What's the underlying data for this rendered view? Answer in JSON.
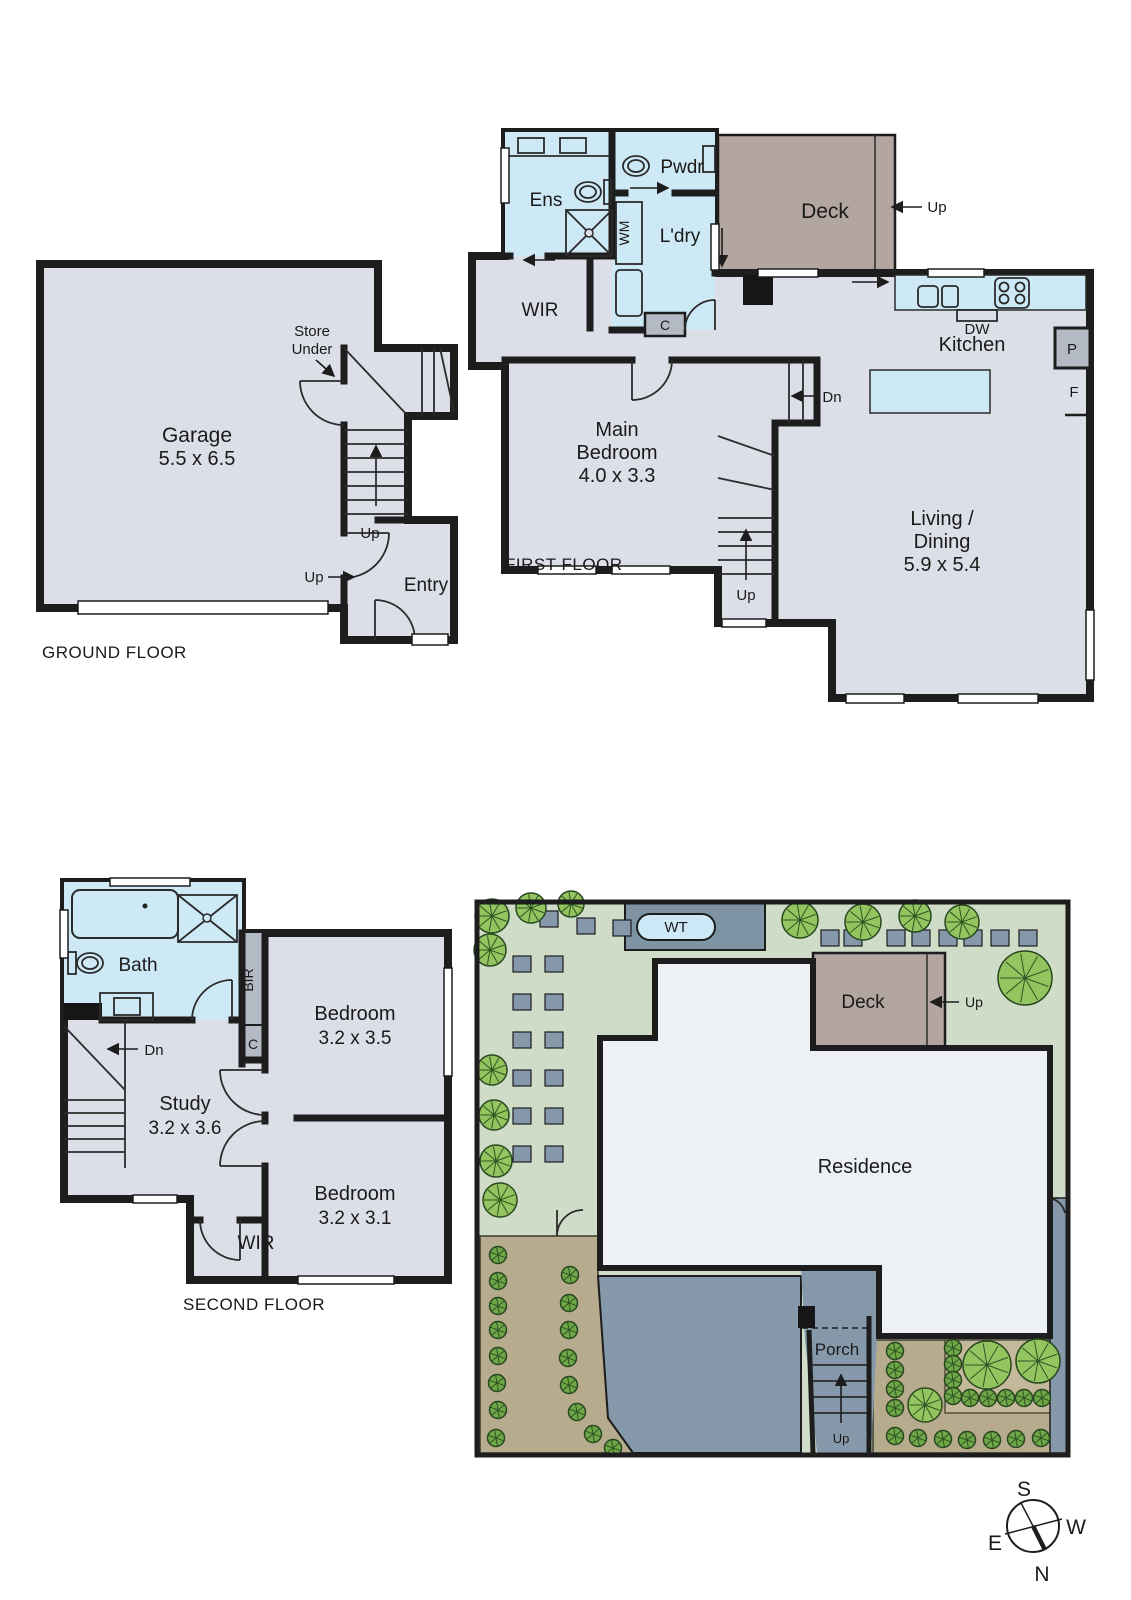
{
  "colors": {
    "wall": "#1d1d1d",
    "room_fill": "#dcdfe7",
    "wet_area_fill": "#cde9f6",
    "deck_fill": "#b3a59f",
    "cupboard_fill": "#b3bac3",
    "residence_fill": "#edf0f5",
    "grass_fill": "#cfdcc8",
    "path_fill": "#b7ab8e",
    "garden_bed_fill": "#c4b99b",
    "driveway_fill": "#8699aa",
    "water_tank_strip_fill": "#7e93a4",
    "water_tank_pill_fill": "#cde9f7",
    "tree_fill": "#94c45f",
    "bush_fill": "#6fa647"
  },
  "ground_floor": {
    "title": "GROUND FLOOR",
    "garage_label": "Garage",
    "garage_dims": "5.5 x 6.5",
    "store_line1": "Store",
    "store_line2": "Under",
    "stairs_up_label": "Up",
    "entry_up_label": "Up",
    "entry_label": "Entry"
  },
  "first_floor": {
    "title": "FIRST FLOOR",
    "ens_label": "Ens",
    "pwdr_label": "Pwdr",
    "wm_label": "WM",
    "ldry_label": "L'dry",
    "cupboard_label": "C",
    "wir_label": "WIR",
    "deck_label": "Deck",
    "deck_up_label": "Up",
    "kitchen_label": "Kitchen",
    "dw_label": "DW",
    "pantry_label": "P",
    "fridge_label": "F",
    "stairs_dn_label": "Dn",
    "stairs_up_label": "Up",
    "main_bedroom_line1": "Main",
    "main_bedroom_line2": "Bedroom",
    "main_bedroom_dims": "4.0 x 3.3",
    "living_line1": "Living /",
    "living_line2": "Dining",
    "living_dims": "5.9 x 5.4"
  },
  "second_floor": {
    "title": "SECOND FLOOR",
    "bath_label": "Bath",
    "bir_label": "BIR",
    "cupboard_label": "C",
    "stairs_dn_label": "Dn",
    "bedroom1_label": "Bedroom",
    "bedroom1_dims": "3.2 x 3.5",
    "study_label": "Study",
    "study_dims": "3.2 x 3.6",
    "bedroom2_label": "Bedroom",
    "bedroom2_dims": "3.2 x 3.1",
    "wir_label": "WIR"
  },
  "site_plan": {
    "water_tank_label": "WT",
    "deck_label": "Deck",
    "deck_up_label": "Up",
    "residence_label": "Residence",
    "porch_label": "Porch",
    "porch_up_label": "Up"
  },
  "compass": {
    "north": "N",
    "south": "S",
    "east": "E",
    "west": "W"
  }
}
